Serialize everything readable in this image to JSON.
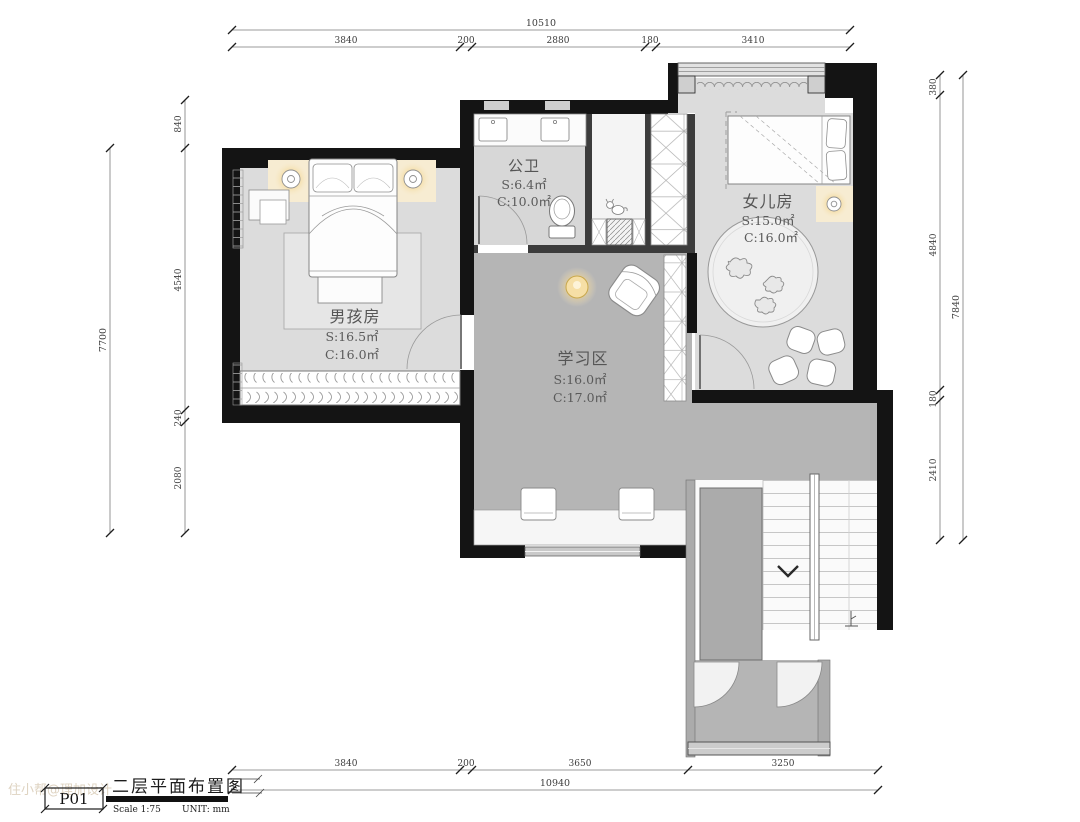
{
  "meta": {
    "page_code": "P01",
    "drawing_title": "二层平面布置图",
    "scale_label": "Scale 1:75",
    "unit_label": "UNIT:  mm"
  },
  "watermark": "住小帮@理加设计",
  "rooms": {
    "bathroom": {
      "name": "公卫",
      "s": "S:6.4㎡",
      "c": "C:10.0㎡"
    },
    "girl": {
      "name": "女儿房",
      "s": "S:15.0㎡",
      "c": "C:16.0㎡"
    },
    "boy": {
      "name": "男孩房",
      "s": "S:16.5㎡",
      "c": "C:16.0㎡"
    },
    "study": {
      "name": "学习区",
      "s": "S:16.0㎡",
      "c": "C:17.0㎡"
    }
  },
  "dimensions": {
    "top": {
      "total": "10510",
      "seg": [
        "3840",
        "200",
        "2880",
        "180",
        "3410"
      ]
    },
    "bottom": {
      "total": "10940",
      "seg": [
        "3840",
        "200",
        "3650",
        "3250"
      ]
    },
    "left": {
      "total": "7700",
      "seg": [
        "840",
        "4540",
        "240",
        "2080"
      ]
    },
    "right": {
      "total": "7840",
      "seg": [
        "380",
        "4840",
        "180",
        "2410"
      ]
    }
  },
  "colors": {
    "wall": "#141414",
    "partition": "#3c3c3c",
    "floor_light": "#dcdcdc",
    "floor_dark": "#b5b5b5",
    "stair_gray": "#ababab",
    "lamp_glow": "#f0c568",
    "dim_line": "#777777"
  }
}
